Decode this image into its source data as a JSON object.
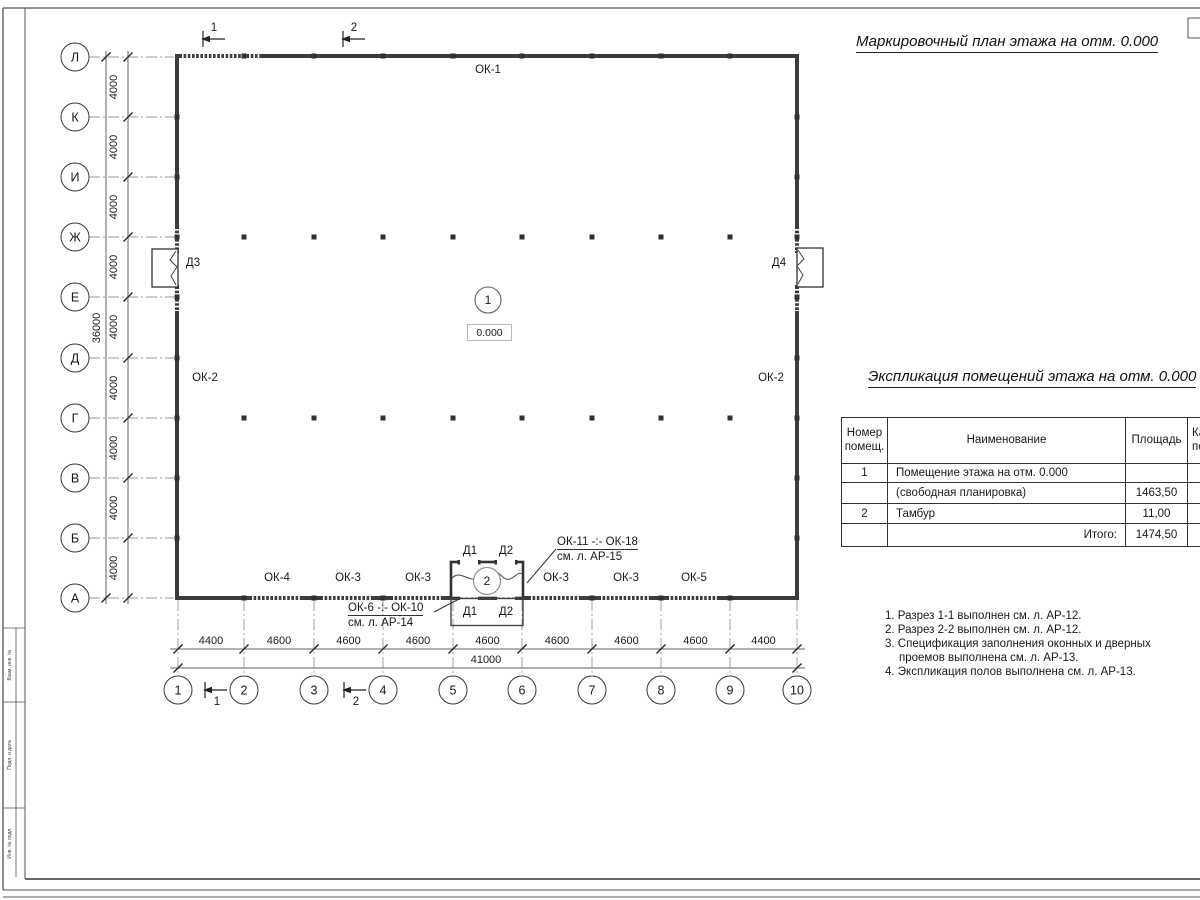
{
  "titles": {
    "plan": "Маркировочный план этажа на отм. 0.000",
    "schedule": "Экспликация помещений этажа на отм. 0.000"
  },
  "axes": {
    "rows": [
      "Л",
      "К",
      "И",
      "Ж",
      "Е",
      "Д",
      "Г",
      "В",
      "Б",
      "А"
    ],
    "cols": [
      "1",
      "2",
      "3",
      "4",
      "5",
      "6",
      "7",
      "8",
      "9",
      "10"
    ]
  },
  "dims": {
    "row_segments": [
      "4000",
      "4000",
      "4000",
      "4000",
      "4000",
      "4000",
      "4000",
      "4000",
      "4000"
    ],
    "row_total": "36000",
    "col_segments": [
      "4400",
      "4600",
      "4600",
      "4600",
      "4600",
      "4600",
      "4600",
      "4600",
      "4400"
    ],
    "col_total": "41000"
  },
  "sections": {
    "s1": "1",
    "s2": "2"
  },
  "plan": {
    "rooms": {
      "r1_number": "1",
      "r1_level": "0.000",
      "r2_number": "2"
    },
    "windows": {
      "top": "ОК-1",
      "left": "ОК-2",
      "right": "ОК-2",
      "bottom": [
        "ОК-4",
        "ОК-3",
        "ОК-3",
        "ОК-3",
        "ОК-3",
        "ОК-5"
      ]
    },
    "doors": {
      "d1": "Д1",
      "d2": "Д2",
      "d3": "Д3",
      "d4": "Д4"
    },
    "callout_windows_upper": {
      "range": "ОК-11 -:- ОК-18",
      "sheet": "см. л. АР-15"
    },
    "callout_windows_lower": {
      "range": "ОК-6 -:- ОК-10",
      "sheet": "см. л. АР-14"
    }
  },
  "schedule_table": {
    "header": {
      "col1_line1": "Номер",
      "col1_line2": "помещ.",
      "col2": "Наименование",
      "col3": "Площадь",
      "col4_line1": "Ка",
      "col4_line2": "по"
    },
    "rows": [
      {
        "num": "1",
        "name": "Помещение этажа на отм. 0.000",
        "area": ""
      },
      {
        "num": "",
        "name": "(свободная планировка)",
        "area": "1463,50"
      },
      {
        "num": "2",
        "name": "Тамбур",
        "area": "11,00"
      },
      {
        "num": "",
        "name": "Итого:",
        "area": "1474,50"
      }
    ]
  },
  "notes": [
    "1. Разрез 1-1 выполнен см. л. АР-12.",
    "2. Разрез 2-2 выполнен см. л. АР-12.",
    "3. Спецификация заполнения оконных и дверных",
    "проемов выполнена см. л. АР-13.",
    "4. Экспликация полов выполнена см. л. АР-13."
  ],
  "frame": {
    "side_labels": [
      "Взам. инв. №",
      "Подп. и дата",
      "Инв. № подл."
    ]
  }
}
